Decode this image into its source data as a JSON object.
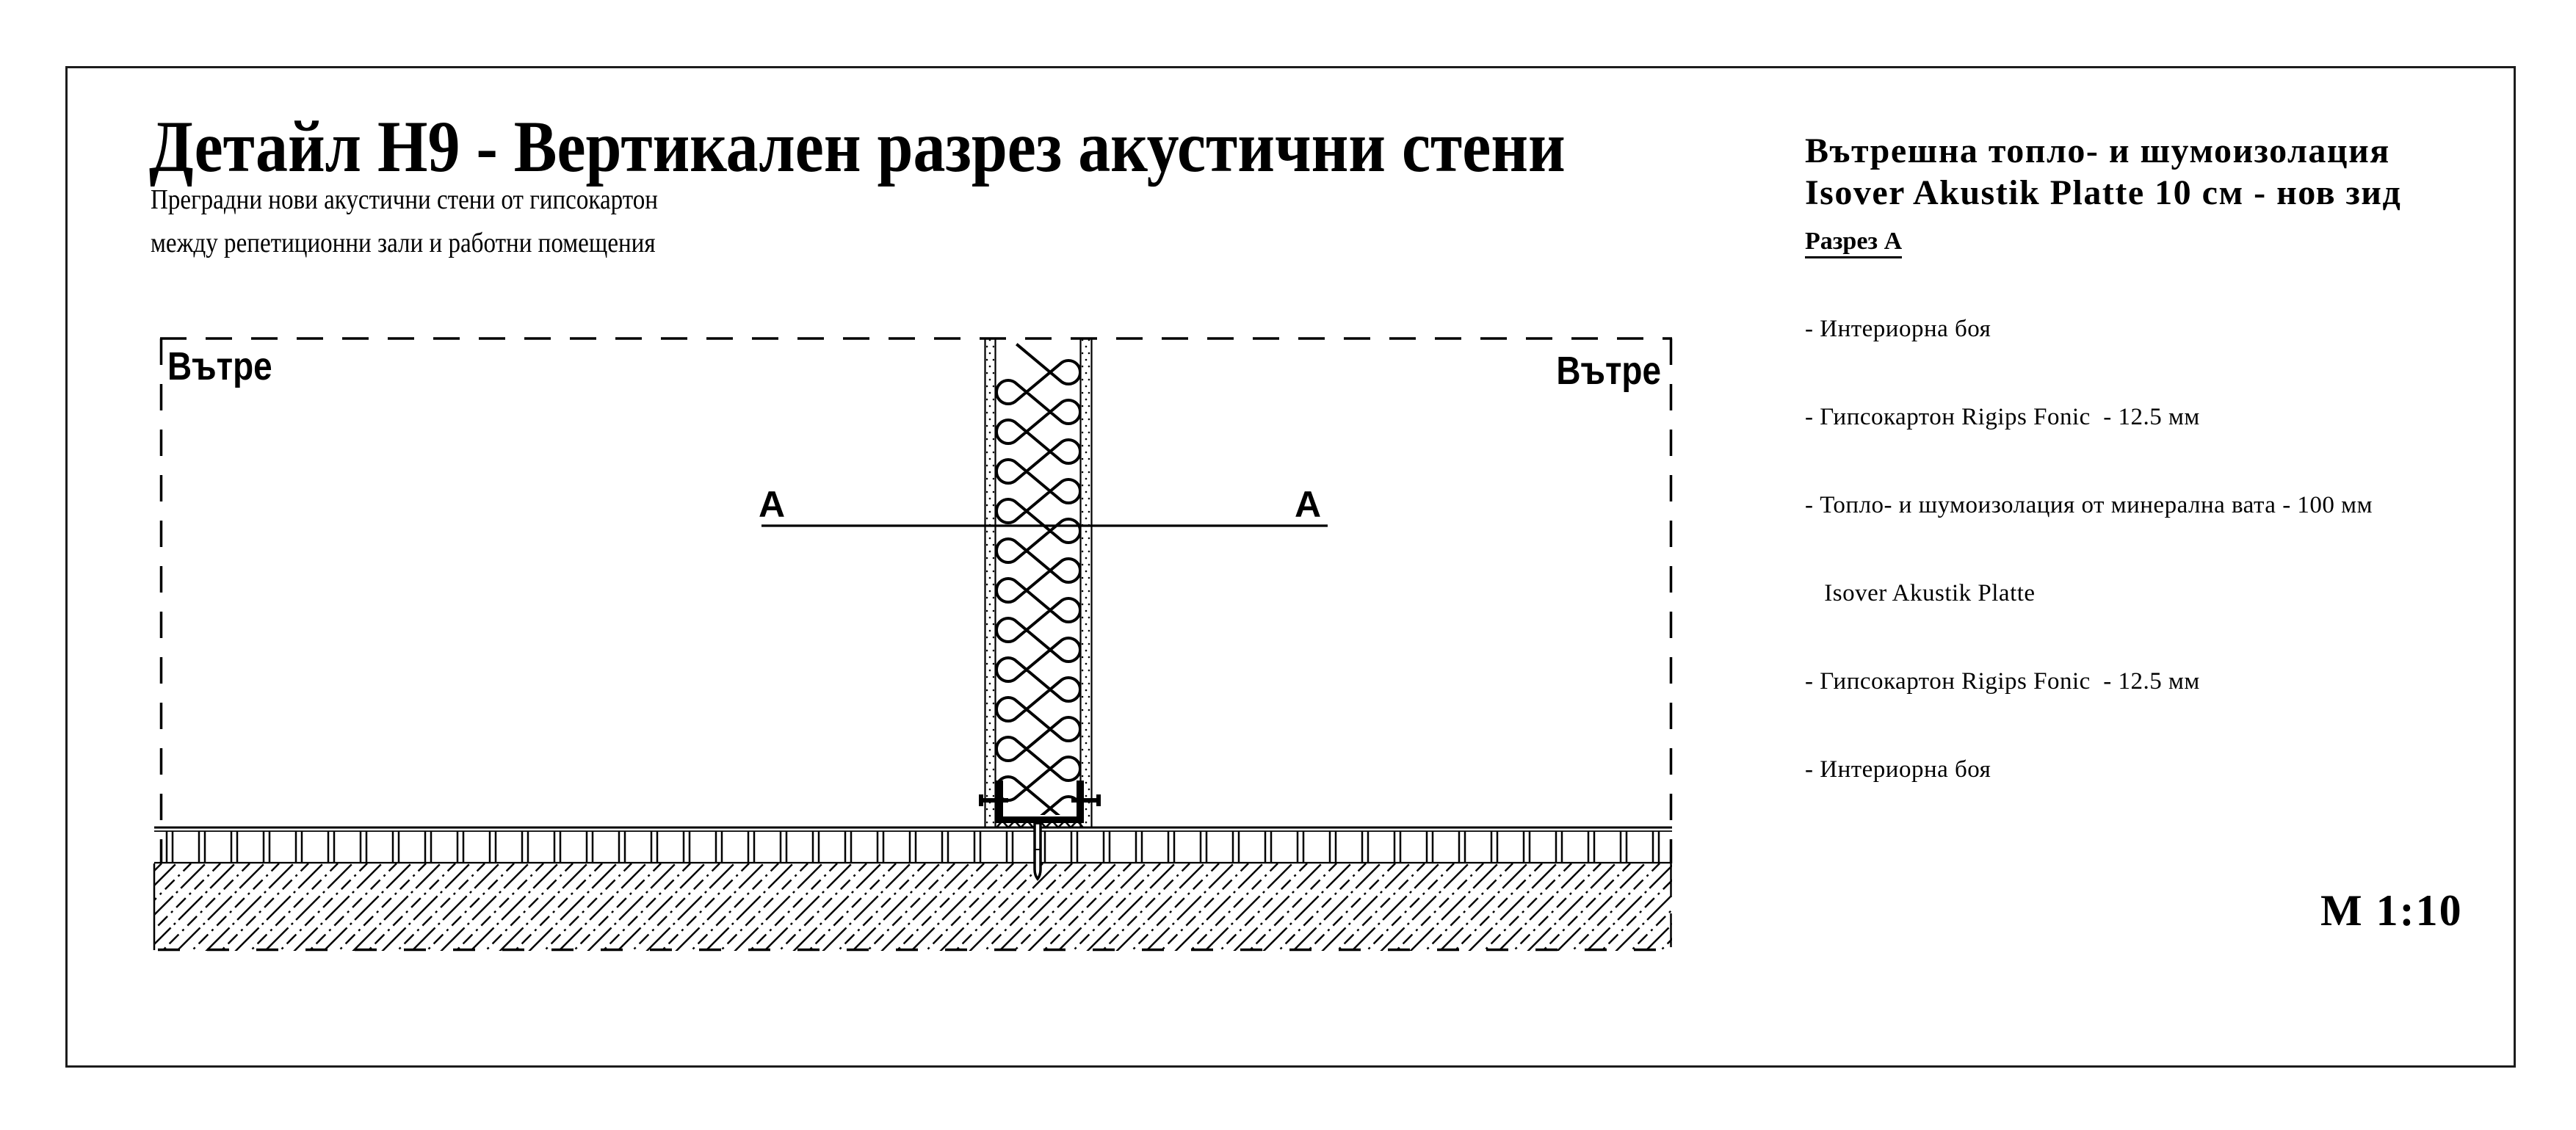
{
  "sheet": {
    "title": "Детайл Н9 - Вертикален разрез акустични стени",
    "subtitle_line1": "Преградни нови акустични стени от гипсокартон",
    "subtitle_line2": "между репетиционни зали и работни помещения",
    "scale_label": "М 1:10"
  },
  "drawing": {
    "room_label_left": "Вътре",
    "room_label_right": "Вътре",
    "section_marker_left": "A",
    "section_marker_right": "A"
  },
  "legend": {
    "heading_line1": "Вътрешна топло- и шумоизолация",
    "heading_line2": "Isover Akustik Platte 10 см - нов зид",
    "section_heading": "Разрез А",
    "items": [
      "- Интериорна боя",
      "- Гипсокартон Rigips Fonic  - 12.5 мм",
      "- Топло- и шумоизолация от минерална вата - 100 мм",
      "   Isover Akustik Platte",
      "- Гипсокартон Rigips Fonic  - 12.5 мм",
      "- Интериорна боя"
    ]
  },
  "colors": {
    "ink": "#000000",
    "paper": "#ffffff"
  }
}
